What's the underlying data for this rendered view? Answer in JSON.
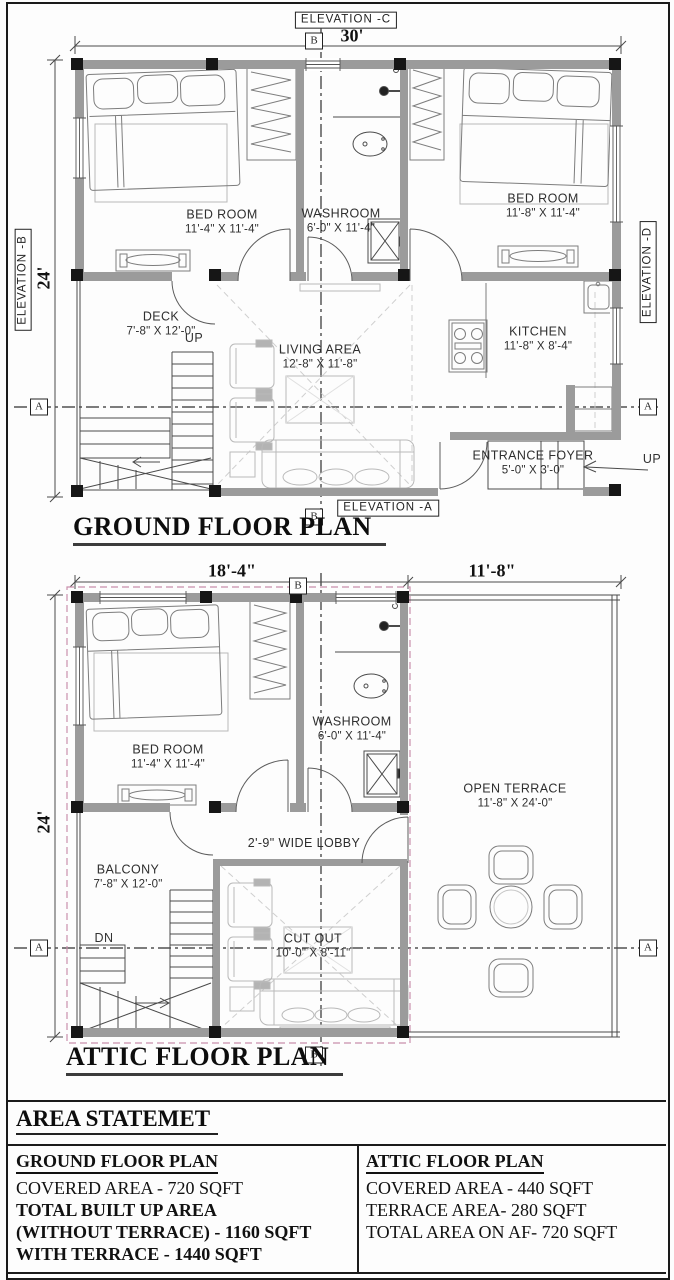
{
  "ground_floor": {
    "title": "GROUND FLOOR PLAN",
    "elevation_top": "ELEVATION -C",
    "elevation_left": "ELEVATION -B",
    "elevation_right": "ELEVATION -D",
    "elevation_bottom": "ELEVATION -A",
    "marker_b_top": "B",
    "marker_b_bottom": "B",
    "marker_a_left": "A",
    "marker_a_right": "A",
    "dim_width": "30'",
    "dim_height": "24'",
    "up_stairs": "UP",
    "up_entrance": "UP",
    "rooms": {
      "bedroom1": {
        "name": "BED ROOM",
        "size": "11'-4\" X 11'-4\""
      },
      "washroom": {
        "name": "WASHROOM",
        "size": "6'-0\" X 11'-4\""
      },
      "bedroom2": {
        "name": "BED ROOM",
        "size": "11'-8\" X 11'-4\""
      },
      "deck": {
        "name": "DECK",
        "size": "7'-8\" X 12'-0\""
      },
      "living": {
        "name": "LIVING AREA",
        "size": "12'-8\" X 11'-8\""
      },
      "kitchen": {
        "name": "KITCHEN",
        "size": "11'-8\" X 8'-4\""
      },
      "entrance": {
        "name": "ENTRANCE FOYER",
        "size": "5'-0\" X 3'-0\""
      }
    }
  },
  "attic_floor": {
    "title": "ATTIC FLOOR PLAN",
    "marker_b_top": "B",
    "marker_b_bottom": "B",
    "marker_a_left": "A",
    "marker_a_right": "A",
    "dim_left": "18'-4\"",
    "dim_right": "11'-8\"",
    "dim_height": "24'",
    "dn_stairs": "DN",
    "rooms": {
      "bedroom": {
        "name": "BED ROOM",
        "size": "11'-4\" X 11'-4\""
      },
      "washroom": {
        "name": "WASHROOM",
        "size": "6'-0\" X 11'-4\""
      },
      "balcony": {
        "name": "BALCONY",
        "size": "7'-8\" X 12'-0\""
      },
      "lobby": {
        "name": "2'-9\" WIDE LOBBY"
      },
      "cutout": {
        "name": "CUT OUT",
        "size": "10'-0\" X 8'-11\""
      },
      "terrace": {
        "name": "OPEN TERRACE",
        "size": "11'-8\" X 24'-0\""
      }
    }
  },
  "area_statement": {
    "heading": "AREA STATEMET",
    "ground": {
      "title": "GROUND FLOOR PLAN",
      "covered": "COVERED AREA - 720 SQFT",
      "total_built": "TOTAL BUILT UP AREA (WITHOUT TERRACE) - 1160 SQFT",
      "with_terrace": "WITH TERRACE - 1440 SQFT"
    },
    "attic": {
      "title": "ATTIC FLOOR PLAN",
      "covered": "COVERED AREA - 440 SQFT",
      "terrace": "TERRACE AREA- 280 SQFT",
      "total": "TOTAL AREA ON AF- 720 SQFT"
    }
  },
  "colors": {
    "wall": "#9b9b9b",
    "post": "#161616",
    "roof_dash": "#c990ad",
    "centerline": "#2f2f2f"
  }
}
